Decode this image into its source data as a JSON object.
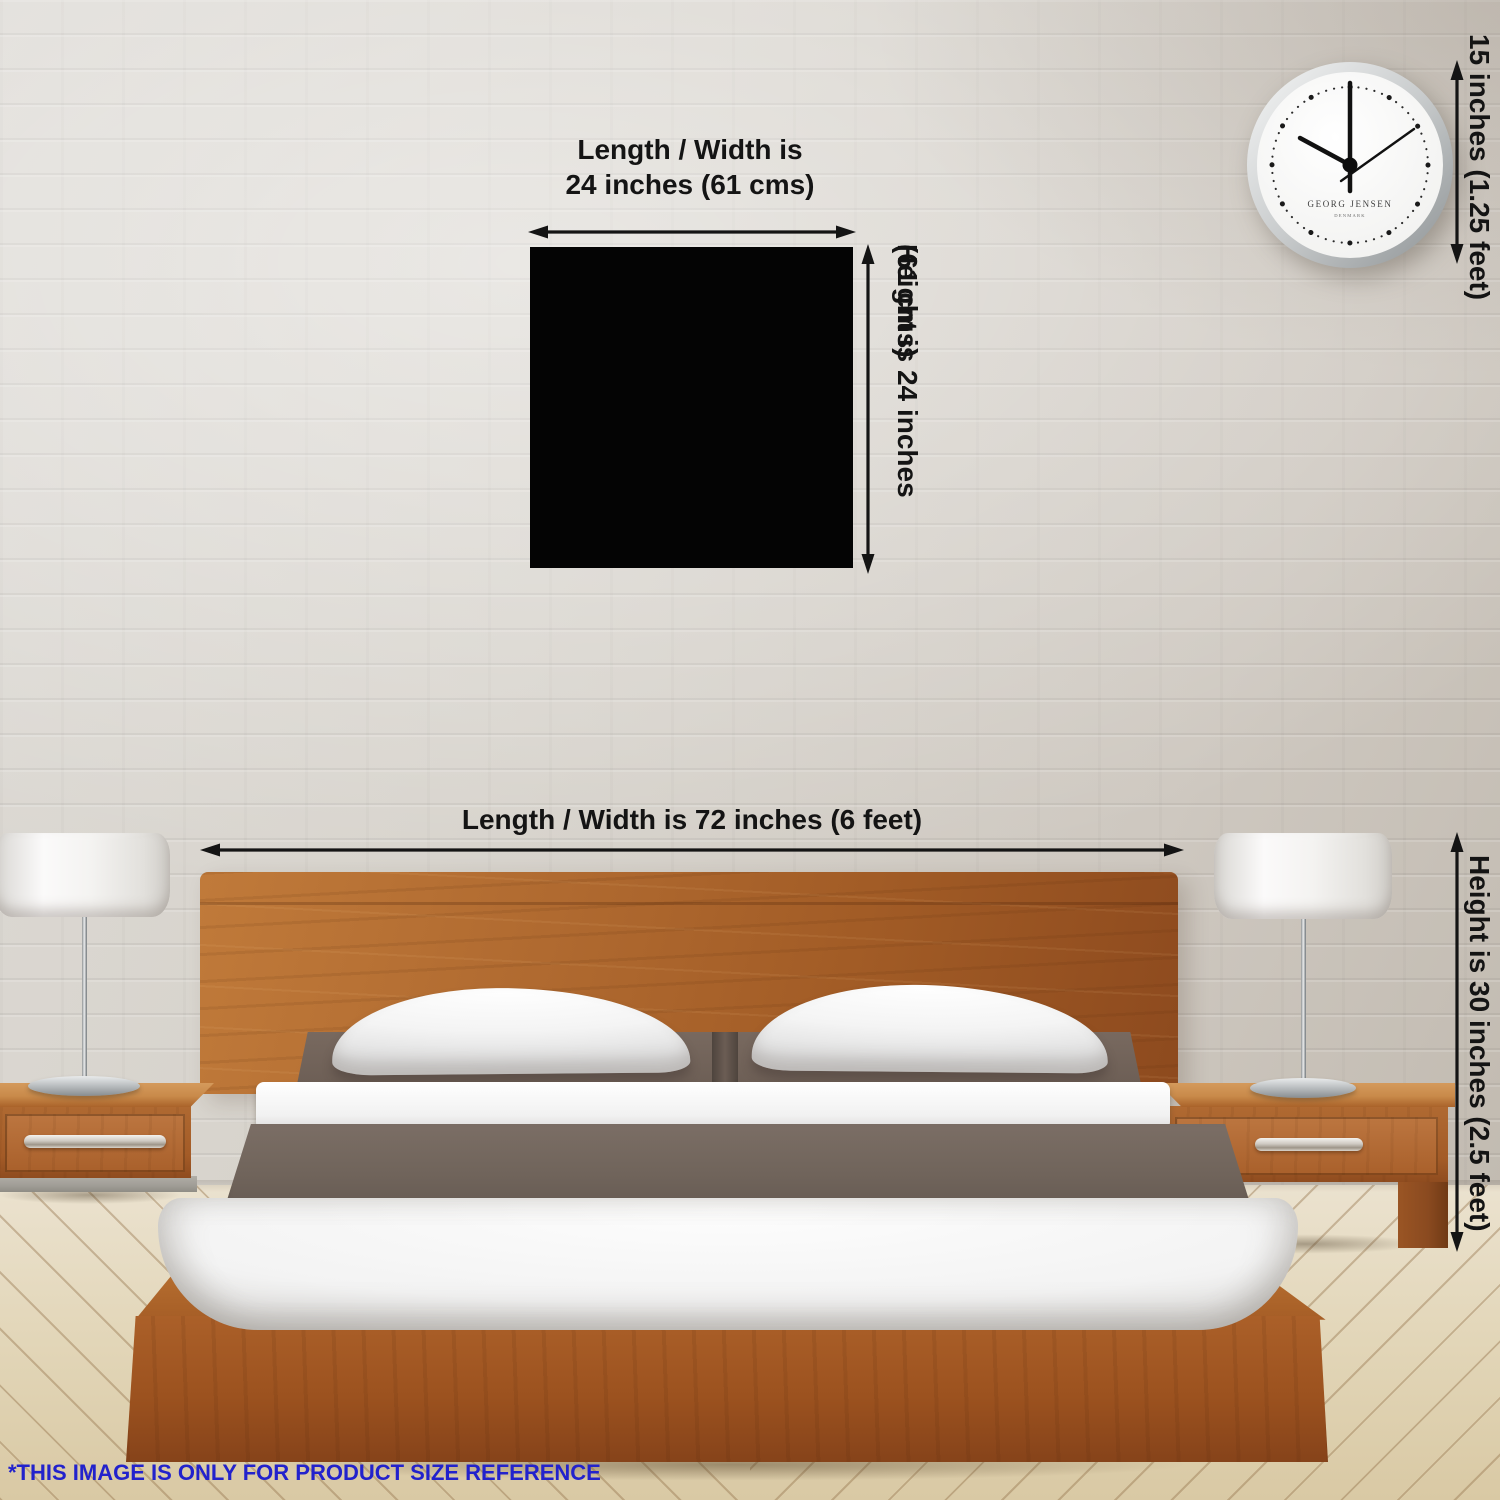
{
  "annotations": {
    "product": {
      "width_line1": "Length / Width is",
      "width_line2": "24 inches (61 cms)",
      "height_line1": "Height is 24 inches",
      "height_line2": "(61 cms)"
    },
    "bed": {
      "width_label": "Length / Width is 72 inches (6 feet)",
      "height_label": "Height is 30 inches (2.5 feet)"
    },
    "clock": {
      "height_label": "15 inches (1.25 feet)"
    }
  },
  "clock_face": {
    "brand": "GEORG JENSEN",
    "origin": "DENMARK"
  },
  "footer": {
    "disclaimer": "*THIS IMAGE IS ONLY FOR PRODUCT SIZE REFERENCE"
  },
  "colors": {
    "annotation_text": "#141414",
    "disclaimer_text": "#2222cc",
    "product_fill": "#040404",
    "wood_accent": "#a55d26",
    "wall": "#d5d1ca",
    "floor": "#e3d7ba",
    "duvet": "#70645b"
  }
}
